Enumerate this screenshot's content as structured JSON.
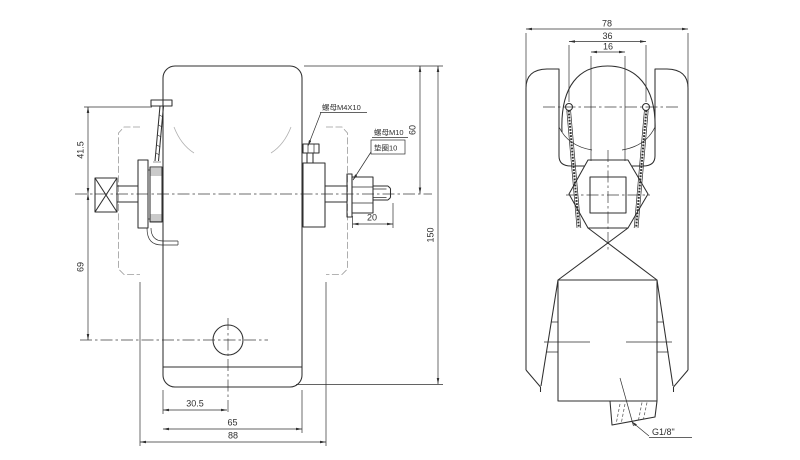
{
  "meta": {
    "type": "engineering-drawing",
    "background": "#ffffff",
    "line_color": "#2f2f2f",
    "phantom_color": "#9a9a9a"
  },
  "front_view": {
    "dims": {
      "bracket_to_center": "41.5",
      "center_to_port": "69",
      "top_to_center": "60",
      "overall_height": "150",
      "nut_stud_length": "20",
      "edge_to_port": "30.5",
      "body_width": "65",
      "overall_depth": "88"
    },
    "labels": {
      "nut_m4": "螺母M4X10",
      "nut_m10": "螺母M10",
      "washer_10": "垫圈10"
    }
  },
  "side_view": {
    "dims": {
      "overall_width": "78",
      "screw_spacing": "36",
      "slot_width": "16"
    },
    "labels": {
      "pipe_thread": "G1/8\""
    }
  }
}
